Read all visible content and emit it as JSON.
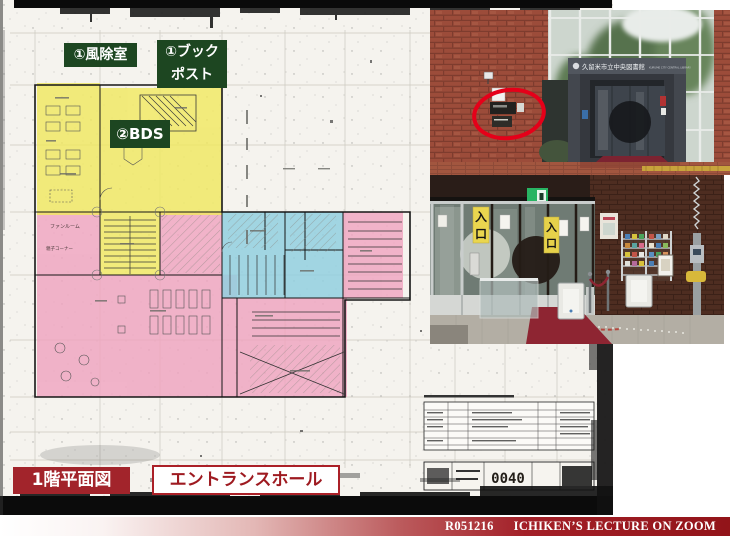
{
  "slide": {
    "background": "#ffffff",
    "accent_red": "#9e1a20",
    "label_green": "#1d4621"
  },
  "floorplan": {
    "callouts": {
      "windbreak": "①風除室",
      "bookpost_line1": "①ブック",
      "bookpost_line2": "ポスト",
      "bds": "②BDS"
    },
    "captions": {
      "plan_title": "1階平面図",
      "entrance_hall": "エントランスホール"
    },
    "room_labels": {
      "fan_room": "ファンルーム",
      "kids_corner": "親子コーナー"
    },
    "stamp_number": "0040",
    "highlight_colors": {
      "yellow": "#f1e95e",
      "pink": "#f0a3bf",
      "blue": "#92cfdf"
    }
  },
  "photos": {
    "exterior": {
      "sign_text": "久留米市立中央図書館",
      "sign_subtext": "KURUME CITY CENTRAL LIBRARY",
      "annotation_color": "#e50019"
    },
    "interior": {
      "entrance_signs": [
        {
          "char_top": "入",
          "char_bottom": "口"
        },
        {
          "char_top": "入",
          "char_bottom": "口"
        }
      ],
      "exit_sign_color": "#28b463"
    }
  },
  "footer": {
    "code": "R051216",
    "title": "ICHIKEN’S LECTURE ON ZOOM",
    "bar_color": "#9e1a20"
  }
}
